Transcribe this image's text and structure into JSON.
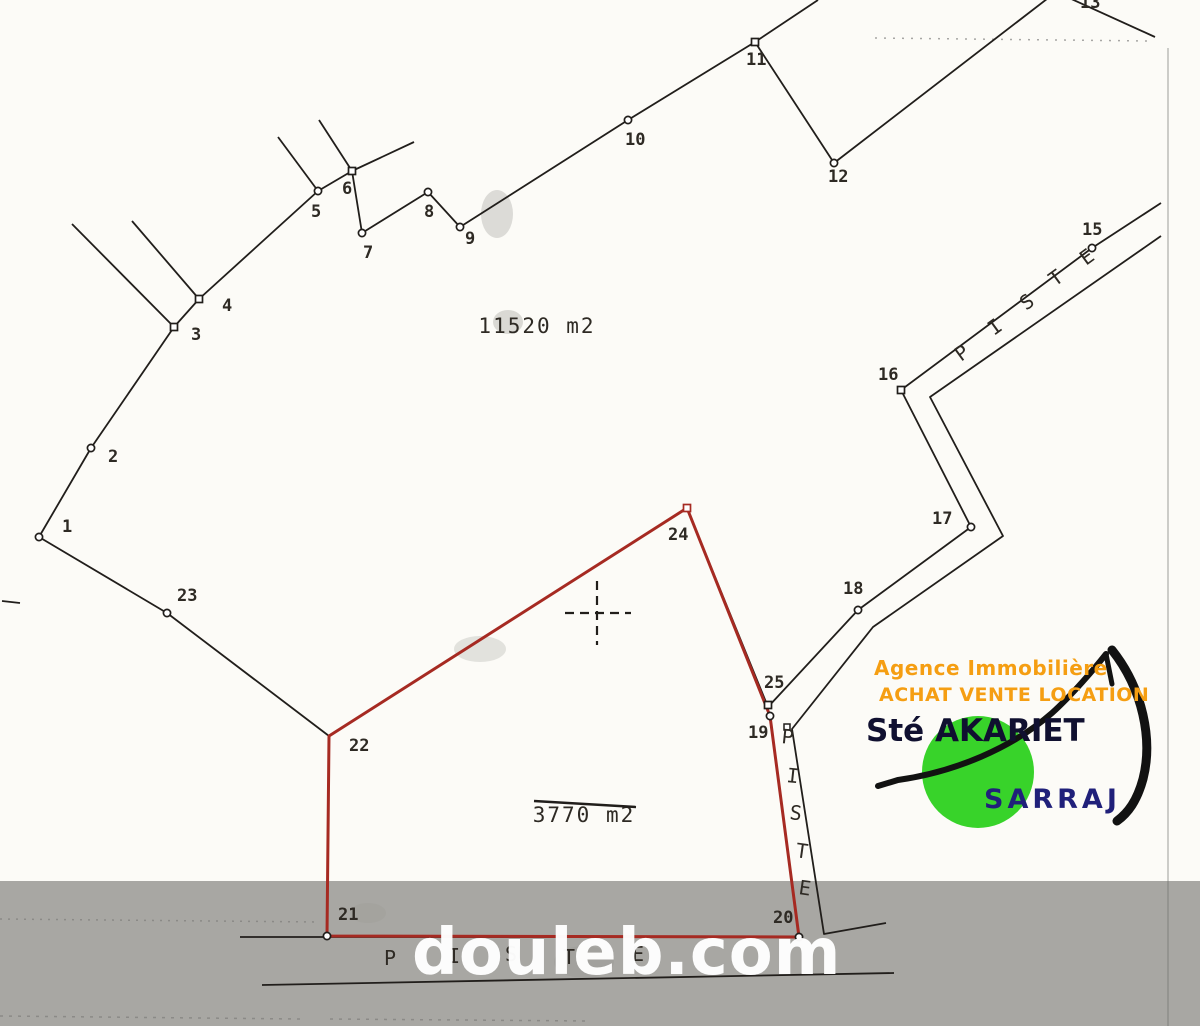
{
  "plan": {
    "band_top": 881,
    "colors": {
      "line": "#211e1b",
      "red": "#a62a22",
      "band": "#a8a7a3",
      "text": "#2e2a24",
      "faint": "#6e6e6c",
      "smudge": "#8a8a86"
    },
    "black_lines": [
      [
        [
          39,
          537
        ],
        [
          91,
          448
        ],
        [
          174,
          327
        ],
        [
          199,
          299
        ],
        [
          318,
          191
        ],
        [
          352,
          171
        ]
      ],
      [
        [
          352,
          171
        ],
        [
          362,
          233
        ],
        [
          428,
          192
        ],
        [
          460,
          227
        ],
        [
          628,
          120
        ],
        [
          755,
          42
        ],
        [
          818,
          0
        ]
      ],
      [
        [
          755,
          42
        ],
        [
          834,
          163
        ],
        [
          1056,
          -8
        ],
        [
          1155,
          37
        ]
      ],
      [
        [
          278,
          137
        ],
        [
          318,
          191
        ]
      ],
      [
        [
          319,
          120
        ],
        [
          352,
          171
        ]
      ],
      [
        [
          352,
          171
        ],
        [
          414,
          142
        ]
      ],
      [
        [
          72,
          224
        ],
        [
          174,
          327
        ]
      ],
      [
        [
          132,
          221
        ],
        [
          199,
          299
        ]
      ],
      [
        [
          39,
          537
        ],
        [
          167,
          613
        ],
        [
          329,
          736
        ]
      ],
      [
        [
          1161,
          203
        ],
        [
          1092,
          248
        ],
        [
          901,
          390
        ],
        [
          971,
          527
        ],
        [
          858,
          610
        ],
        [
          768,
          707
        ]
      ],
      [
        [
          1161,
          236
        ],
        [
          930,
          397
        ],
        [
          1003,
          536
        ],
        [
          873,
          627
        ],
        [
          792,
          729
        ],
        [
          824,
          934
        ],
        [
          886,
          923
        ]
      ],
      [
        [
          329,
          736
        ],
        [
          687,
          508
        ],
        [
          768,
          707
        ]
      ],
      [
        [
          240,
          937
        ],
        [
          799,
          937
        ]
      ],
      [
        [
          262,
          985
        ],
        [
          894,
          973
        ]
      ],
      [
        [
          2,
          601
        ],
        [
          20,
          603
        ]
      ]
    ],
    "dashed_lines": [
      {
        "p": [
          [
            875,
            38
          ],
          [
            1150,
            41
          ]
        ],
        "w": 1.5,
        "d": "2 7",
        "o": 0.6
      },
      {
        "p": [
          [
            0,
            919
          ],
          [
            320,
            922
          ]
        ],
        "w": 1.5,
        "d": "2 6",
        "o": 0.5
      },
      {
        "p": [
          [
            0,
            1016
          ],
          [
            300,
            1019
          ]
        ],
        "w": 1.5,
        "d": "3 6",
        "o": 0.5
      },
      {
        "p": [
          [
            330,
            1019
          ],
          [
            590,
            1021
          ]
        ],
        "w": 1.5,
        "d": "3 6",
        "o": 0.5
      },
      {
        "p": [
          [
            1168,
            48
          ],
          [
            1168,
            1026
          ]
        ],
        "w": 1.5,
        "d": "1 0",
        "o": 0.45
      }
    ],
    "red_parcel": [
      [
        329,
        736
      ],
      [
        687,
        508
      ],
      [
        770,
        716
      ],
      [
        799,
        937
      ],
      [
        327,
        936
      ]
    ],
    "cross": {
      "x": 597,
      "y": 613
    },
    "extra_markers": [
      [
        787,
        727
      ]
    ],
    "points": [
      {
        "label": "1",
        "m": "c",
        "x": 39,
        "y": 537,
        "lx": 62,
        "ly": 532
      },
      {
        "label": "2",
        "m": "c",
        "x": 91,
        "y": 448,
        "lx": 108,
        "ly": 462
      },
      {
        "label": "3",
        "m": "s",
        "x": 174,
        "y": 327,
        "lx": 191,
        "ly": 340
      },
      {
        "label": "4",
        "m": "s",
        "x": 199,
        "y": 299,
        "lx": 222,
        "ly": 311
      },
      {
        "label": "5",
        "m": "c",
        "x": 318,
        "y": 191,
        "lx": 311,
        "ly": 217
      },
      {
        "label": "6",
        "m": "s",
        "x": 352,
        "y": 171,
        "lx": 342,
        "ly": 194
      },
      {
        "label": "7",
        "m": "c",
        "x": 362,
        "y": 233,
        "lx": 363,
        "ly": 258
      },
      {
        "label": "8",
        "m": "c",
        "x": 428,
        "y": 192,
        "lx": 424,
        "ly": 217
      },
      {
        "label": "9",
        "m": "c",
        "x": 460,
        "y": 227,
        "lx": 465,
        "ly": 244
      },
      {
        "label": "10",
        "m": "c",
        "x": 628,
        "y": 120,
        "lx": 625,
        "ly": 145
      },
      {
        "label": "11",
        "m": "s",
        "x": 755,
        "y": 42,
        "lx": 746,
        "ly": 65
      },
      {
        "label": "12",
        "m": "c",
        "x": 834,
        "y": 163,
        "lx": 828,
        "ly": 182
      },
      {
        "label": "13",
        "m": "n",
        "x": 1056,
        "y": -8,
        "lx": 1080,
        "ly": 8
      },
      {
        "label": "15",
        "m": "c",
        "x": 1092,
        "y": 248,
        "lx": 1082,
        "ly": 235
      },
      {
        "label": "16",
        "m": "s",
        "x": 901,
        "y": 390,
        "lx": 878,
        "ly": 380
      },
      {
        "label": "17",
        "m": "c",
        "x": 971,
        "y": 527,
        "lx": 932,
        "ly": 524
      },
      {
        "label": "18",
        "m": "c",
        "x": 858,
        "y": 610,
        "lx": 843,
        "ly": 594
      },
      {
        "label": "19",
        "m": "c",
        "x": 770,
        "y": 716,
        "lx": 748,
        "ly": 738
      },
      {
        "label": "20",
        "m": "c",
        "x": 799,
        "y": 937,
        "lx": 773,
        "ly": 923
      },
      {
        "label": "21",
        "m": "c",
        "x": 327,
        "y": 936,
        "lx": 338,
        "ly": 920
      },
      {
        "label": "22",
        "m": "n",
        "x": 329,
        "y": 736,
        "lx": 349,
        "ly": 751
      },
      {
        "label": "23",
        "m": "c",
        "x": 167,
        "y": 613,
        "lx": 177,
        "ly": 601
      },
      {
        "label": "24",
        "m": "s",
        "red": true,
        "x": 687,
        "y": 508,
        "lx": 668,
        "ly": 540
      },
      {
        "label": "25",
        "m": "s",
        "x": 768,
        "y": 705,
        "lx": 764,
        "ly": 688
      }
    ],
    "area_labels": [
      {
        "text": "11520 m2",
        "x": 537,
        "y": 333
      },
      {
        "text": "3770 m2",
        "x": 584,
        "y": 822,
        "line": [
          534,
          801,
          636,
          807
        ]
      }
    ],
    "piste_labels": [
      {
        "glyphs": [
          [
            "P",
            961,
            362,
            -36
          ],
          [
            "I",
            994,
            336,
            -36
          ],
          [
            "S",
            1026,
            311,
            -36
          ],
          [
            "T",
            1055,
            287,
            -36
          ],
          [
            "E",
            1086,
            266,
            -36
          ]
        ]
      },
      {
        "glyphs": [
          [
            "P",
            781,
            743,
            6
          ],
          [
            "I",
            786,
            782,
            6
          ],
          [
            "S",
            789,
            819,
            7
          ],
          [
            "T",
            795,
            857,
            8
          ],
          [
            "E",
            798,
            894,
            8
          ]
        ]
      },
      {
        "glyphs": [
          [
            "P",
            384,
            965,
            0
          ],
          [
            "I",
            448,
            963,
            0
          ],
          [
            "S",
            505,
            961,
            0
          ],
          [
            "T",
            563,
            964,
            0
          ],
          [
            "E",
            632,
            961,
            0
          ]
        ]
      }
    ],
    "smudges": [
      [
        497,
        214,
        16,
        24,
        0.28
      ],
      [
        508,
        322,
        15,
        12,
        0.3
      ],
      [
        480,
        649,
        26,
        13,
        0.22
      ],
      [
        584,
        962,
        30,
        16,
        0.18
      ],
      [
        368,
        913,
        18,
        10,
        0.15
      ]
    ]
  },
  "logo": {
    "line1": "Agence Immobilière",
    "line2": "ACHAT VENTE LOCATION",
    "line3": "Sté AKARIET",
    "line4": "SARRAJ",
    "orange": "#f59e12",
    "green": "#38d32a",
    "navy": "#20207a",
    "dark": "#101030",
    "black": "#121212",
    "circle": [
      978,
      772,
      56
    ],
    "swoosh": [
      {
        "d": "M 878 786 L 898 780 C 955 772 1012 748 1052 713 C 1072 695 1095 668 1106 654",
        "w": 6
      },
      {
        "d": "M 1106 654 L 1112 684",
        "w": 5
      },
      {
        "d": "M 1112 650 C 1143 689 1153 740 1143 779 C 1137 801 1128 813 1117 821",
        "w": 9
      }
    ]
  },
  "watermark": {
    "text": "douleb.com"
  }
}
